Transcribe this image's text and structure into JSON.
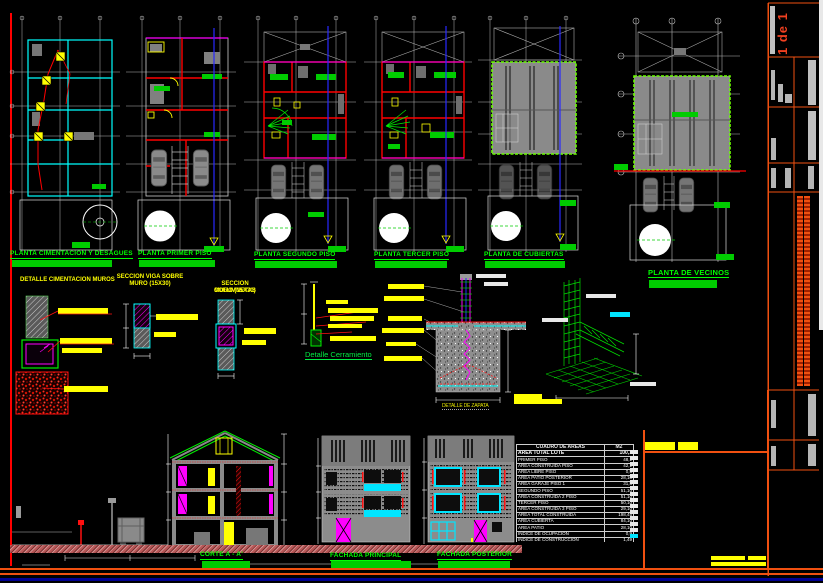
{
  "sheet": {
    "page": "1 de 1"
  },
  "plan_labels": [
    "PLANTA CIMENTACION Y DESAGUES",
    "PLANTA PRIMER PISO",
    "PLANTA SEGUNDO PISO",
    "PLANTA TERCER PISO",
    "PLANTA DE CUBIERTAS",
    "PLANTA DE VECINOS"
  ],
  "details": {
    "cimentacion_muros": "DETALLE CIMENTACION MUROS",
    "viga_line1": "SECCION VIGA SOBRE",
    "viga_line2": "MURO (15X30)",
    "columnetas_line1": "SECCION COLUMNETAS",
    "columnetas_line2": "MURO (15X30)",
    "cerramiento": "Detalle Cerramiento",
    "zapata": "DETALLE DE ZAPATA"
  },
  "sections": {
    "corte": "CORTE  A - A'",
    "fachada_principal": "FACHADA    PRINCIPAL",
    "fachada_posterior": "FACHADA POSTERIOR"
  },
  "areas_table": {
    "title": "CUADRO DE AREAS",
    "unit": "M2",
    "rows": [
      [
        "AREA TOTAL LOTE",
        "100,1"
      ],
      [
        "PRIMER PISO",
        "48,1"
      ],
      [
        "AREA CONSTRUIDA PISO",
        "42,1"
      ],
      [
        "AREA LIBRE PISO",
        "0,5"
      ],
      [
        "AREA PATIO POSTERIOR",
        "28,10"
      ],
      [
        "AREA GARAJE PISO 1",
        "31,8"
      ],
      [
        "SEGUNDO PISO",
        "51,10"
      ],
      [
        "AREA CONSTRUIDA 2 PISO",
        "51,10"
      ],
      [
        "TERCER PISO",
        "50,10"
      ],
      [
        "AREA CONSTRUIDA 3 PISO",
        "29,10"
      ],
      [
        "AREA TOTAL CONSTRUIDA",
        "198,45"
      ],
      [
        "AREA CUBIERTA",
        "84,10"
      ],
      [
        "AREA PATIO",
        "28,10"
      ],
      [
        "INDICE DE OCUPACION",
        "0,9"
      ],
      [
        "INDICE DE CONSTRUCCION",
        "1,49"
      ]
    ]
  },
  "colors": {
    "label_green": "#00ff00",
    "highlight_yellow": "#ffff00",
    "wall_cyan": "#00ffff",
    "wall_red": "#ff0000",
    "accent_magenta": "#ff00ff",
    "frame_orange": "#f05010",
    "sheet_navy": "#000090"
  }
}
